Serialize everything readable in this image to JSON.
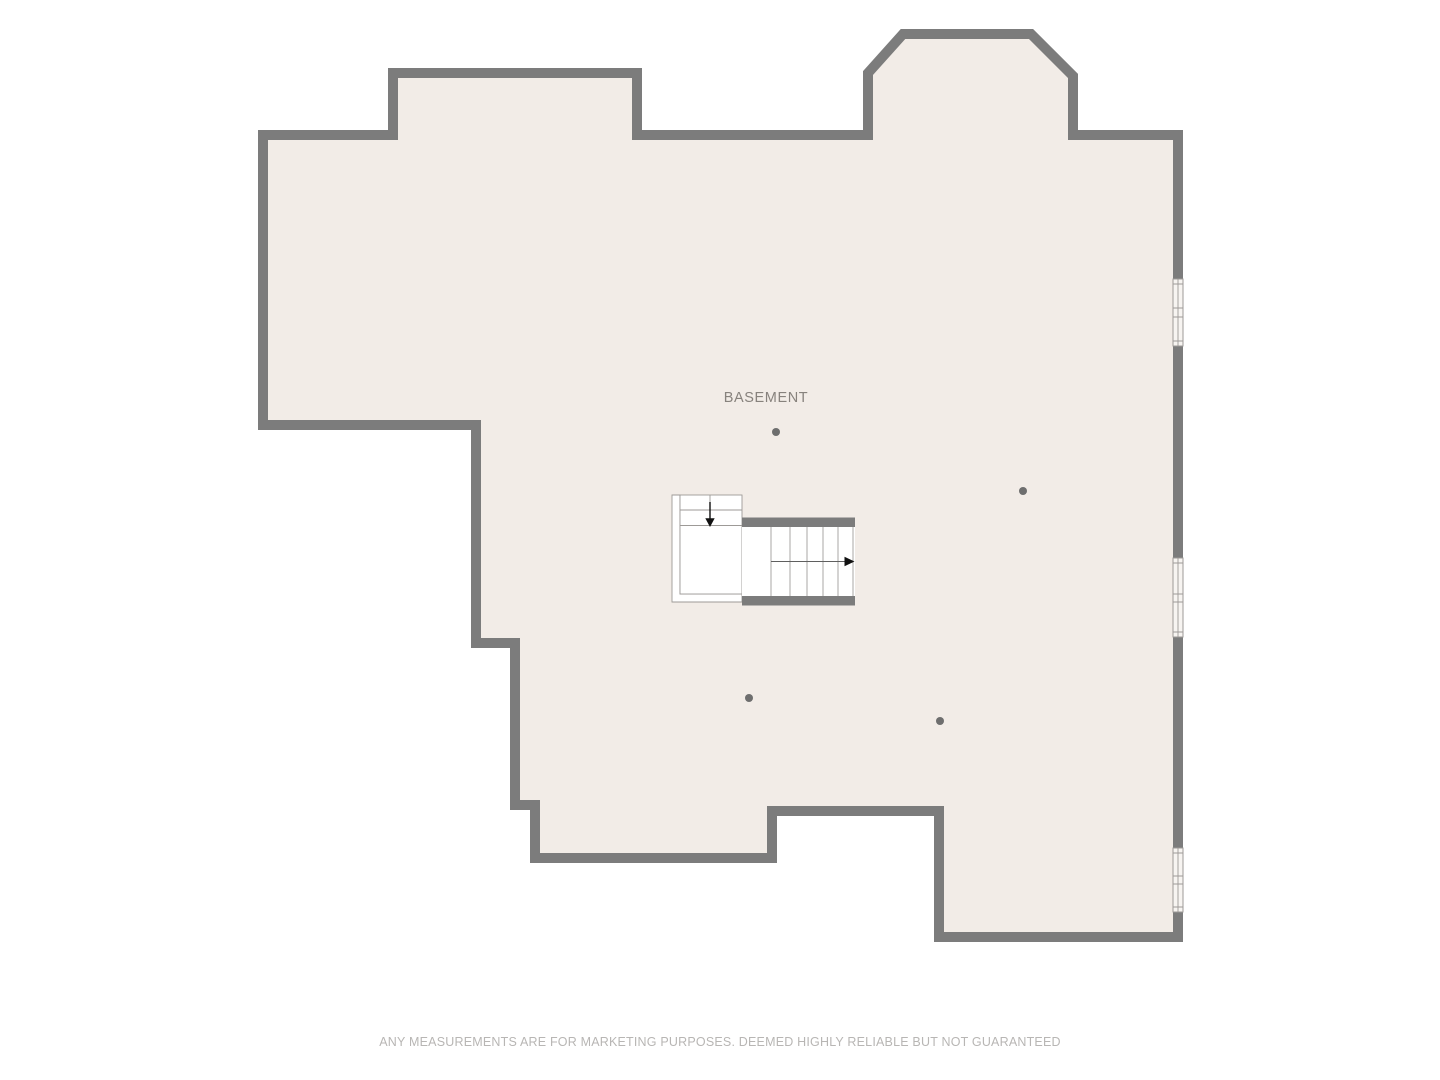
{
  "colors": {
    "background": "#ffffff",
    "floor": "#f2ece7",
    "wall": "#7c7c7c",
    "line": "#9d9a97",
    "stair-fill": "#ffffff",
    "window-fill": "#f7f4f1",
    "dot": "#6e6e6e",
    "label": "#87827d",
    "arrow": "#111111",
    "run-line": "#5f5f5f",
    "disclaimer": "#b8b6b4"
  },
  "floorplan": {
    "room_label": "BASEMENT",
    "window_pairs": 3,
    "support_columns": 4
  },
  "footer": {
    "disclaimer": "ANY MEASUREMENTS ARE FOR MARKETING PURPOSES. DEEMED HIGHLY RELIABLE BUT NOT GUARANTEED"
  }
}
